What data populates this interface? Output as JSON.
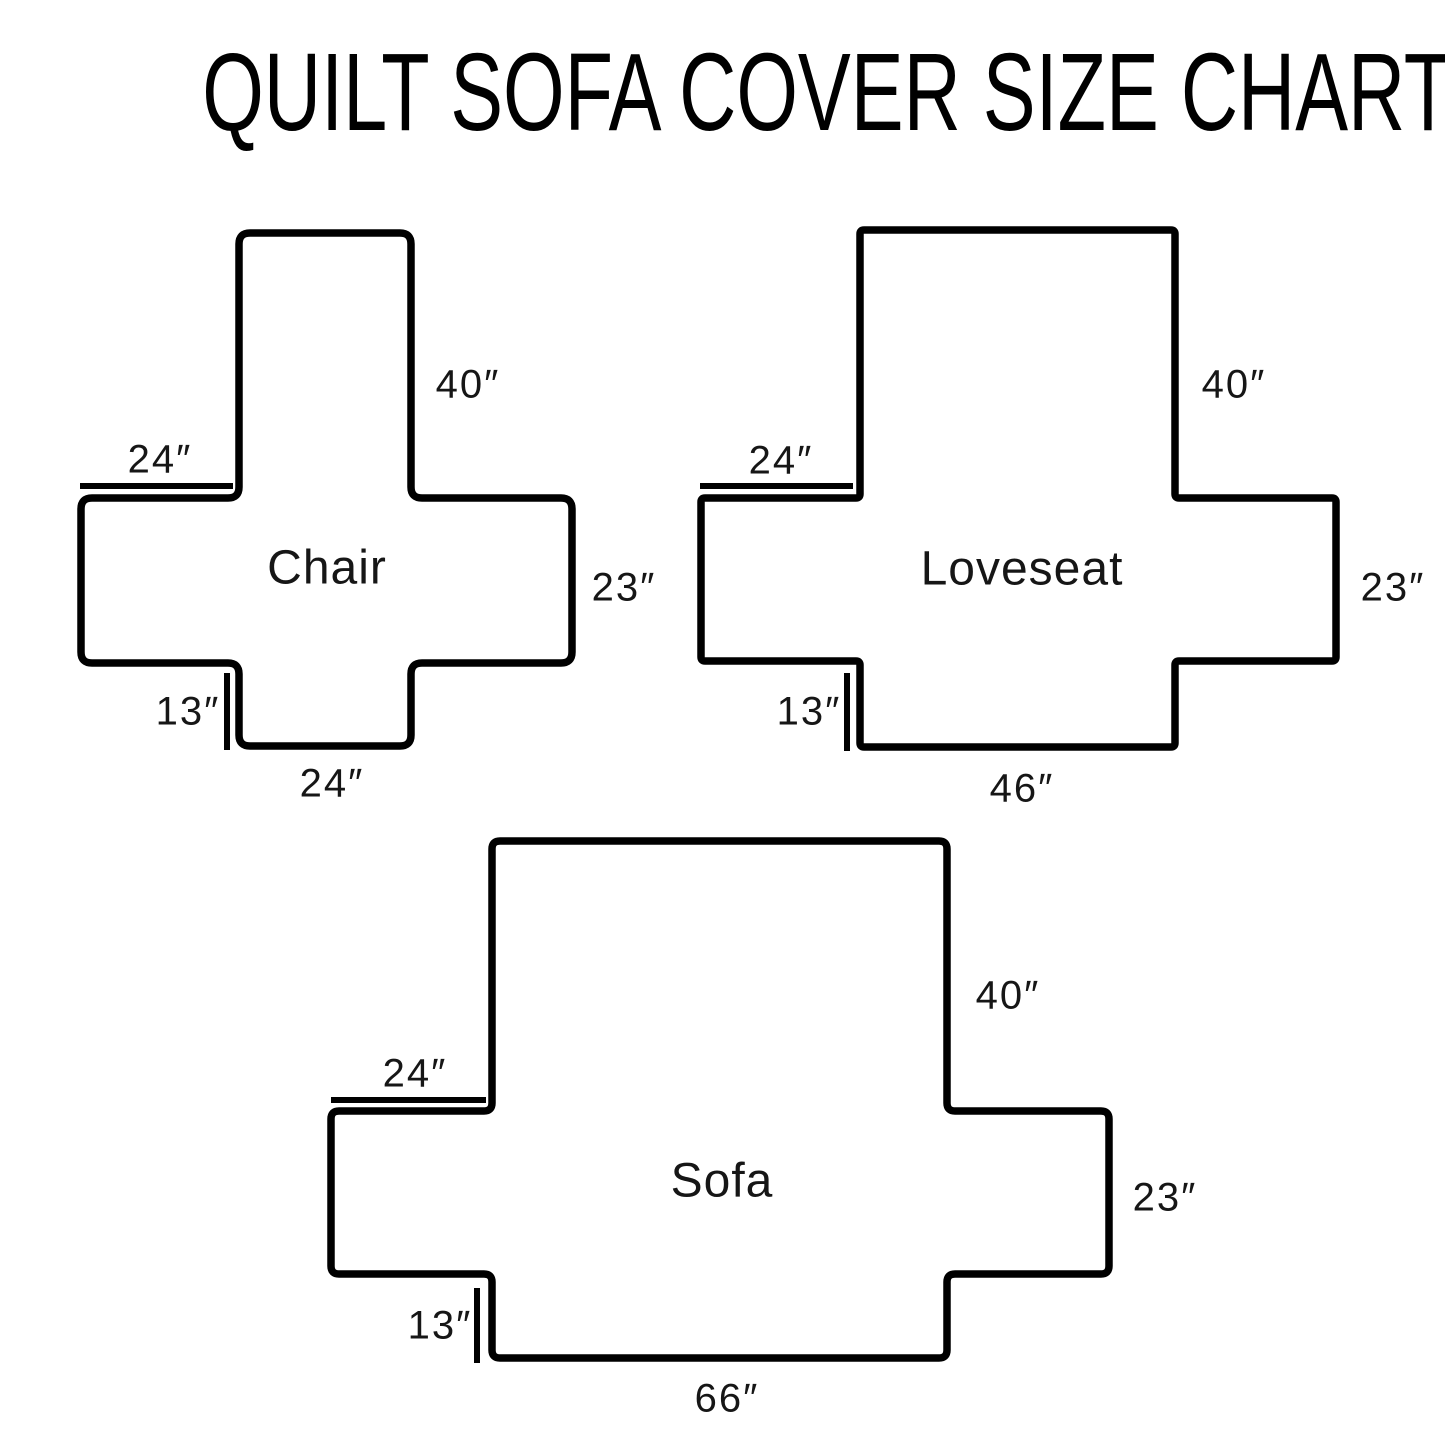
{
  "title": "QUILT SOFA COVER SIZE CHART",
  "diagrams": [
    {
      "name": "Chair",
      "back_height": "40″",
      "arm_width": "24″",
      "side_height": "23″",
      "front_drop": "13″",
      "bottom_width": "24″"
    },
    {
      "name": "Loveseat",
      "back_height": "40″",
      "arm_width": "24″",
      "side_height": "23″",
      "front_drop": "13″",
      "bottom_width": "46″"
    },
    {
      "name": "Sofa",
      "back_height": "40″",
      "arm_width": "24″",
      "side_height": "23″",
      "front_drop": "13″",
      "bottom_width": "66″"
    }
  ],
  "colors": {
    "outline": "#000000",
    "text": "#161616",
    "background": "#ffffff"
  }
}
